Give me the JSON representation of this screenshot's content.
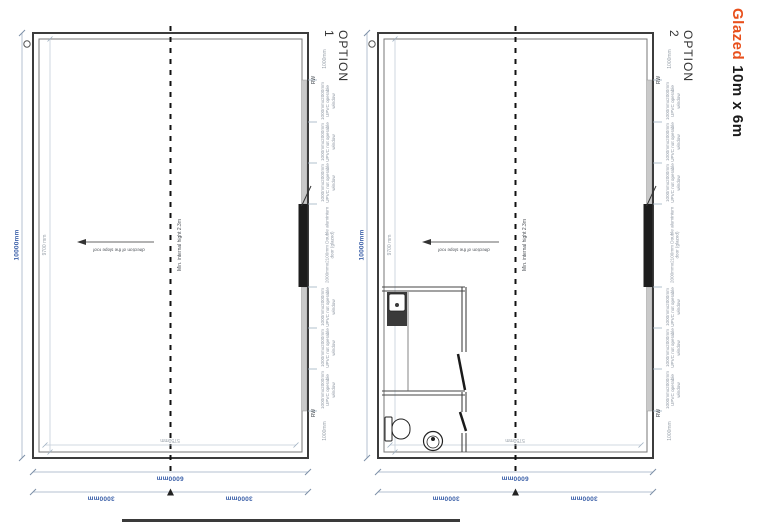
{
  "title": {
    "accent": "Glazed",
    "rest": "10m x 6m"
  },
  "plans": [
    {
      "name": "OPTION 1",
      "dim_overall_height": "10000mm",
      "dim_internal_height": "9700 mm",
      "dim_internal_width": "5750mm",
      "dim_overall_width": "6000mm",
      "dim_half_1": "3000mm",
      "dim_half_2": "3000mm",
      "centerline_note": "Min. internal hight 2.3m",
      "slope_note": "direction of the slope roof",
      "edge_labels": [
        {
          "text": "1000mm"
        },
        {
          "text": "RW"
        },
        {
          "text": "1000mmx2000mm UPVC operable window"
        },
        {
          "text": "1000mmx2000mm UPVC not operable window"
        },
        {
          "text": "1000mmx2000mm UPVC not operable window"
        },
        {
          "text": "2000mmx2100mm Double aluminium door (glazed)"
        },
        {
          "text": "1000mmx2000mm UPVC not operable window"
        },
        {
          "text": "1000mmx2000mm UPVC not operable window"
        },
        {
          "text": "1000mmx2000mm UPVC operable window"
        },
        {
          "text": "RW"
        },
        {
          "text": "1000mm"
        }
      ]
    },
    {
      "name": "OPTION 2",
      "dim_overall_height": "10000mm",
      "dim_internal_height": "9700 mm",
      "dim_internal_width": "5750mm",
      "dim_overall_width": "6000mm",
      "dim_half_1": "3000mm",
      "dim_half_2": "3000mm",
      "centerline_note": "Min. internal hight 2.3m",
      "slope_note": "direction of the slope roof",
      "edge_labels": [
        {
          "text": "1000mm"
        },
        {
          "text": "RW"
        },
        {
          "text": "1000mmx2000mm UPVC operable window"
        },
        {
          "text": "1000mmx2000mm UPVC not operable window"
        },
        {
          "text": "1000mmx2000mm UPVC not operable window"
        },
        {
          "text": "2000mmx2100mm Double aluminium door (glazed)"
        },
        {
          "text": "1000mmx2000mm UPVC not operable window"
        },
        {
          "text": "1000mmx2000mm UPVC not operable window"
        },
        {
          "text": "1000mmx2000mm UPVC operable window"
        },
        {
          "text": "RW"
        },
        {
          "text": "1000mm"
        }
      ]
    }
  ]
}
